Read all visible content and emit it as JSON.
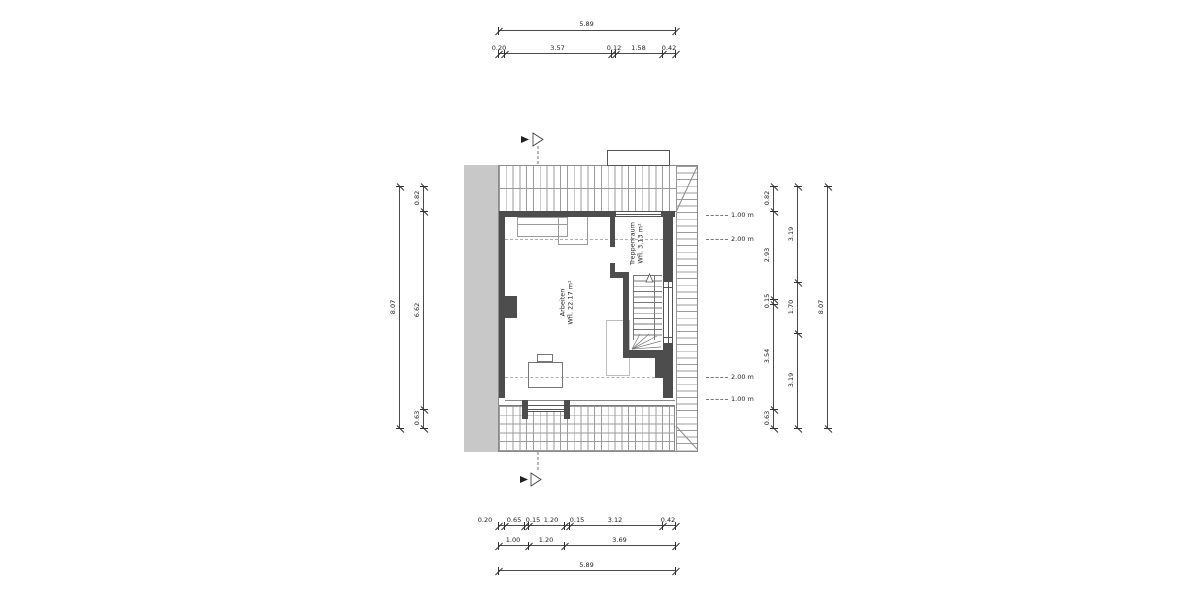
{
  "rooms": {
    "arbeiten": {
      "name": "Arbeiten",
      "area": "Wfl. 22.17 m²"
    },
    "treppenraum": {
      "name": "Treppenraum",
      "area": "Wfl. 3.13 m²"
    }
  },
  "dims": {
    "top_overall": "5.89",
    "top_segments": [
      "0.20",
      "3.57",
      "0.12",
      "1.58",
      "0.42"
    ],
    "bottom_segments": [
      "0.20",
      "0.65",
      "0.15",
      "1.20",
      "0.15",
      "3.12",
      "0.42"
    ],
    "bottom_mid": [
      "1.00",
      "1.20",
      "3.69"
    ],
    "bottom_overall": "5.89",
    "left_segments": [
      "0.82",
      "6.62",
      "0.63"
    ],
    "left_overall": "8.07",
    "right_inner": [
      "0.82",
      "2.93",
      "0.15",
      "3.54",
      "0.63"
    ],
    "right_mid": [
      "3.19",
      "1.70",
      "3.19"
    ],
    "right_overall": "8.07"
  },
  "height_markers": [
    {
      "label": "1.00 m"
    },
    {
      "label": "2.00 m"
    },
    {
      "label": "2.00 m"
    },
    {
      "label": "1.00 m"
    }
  ],
  "colors": {
    "wall": "#4d4d4d",
    "party_wall": "#c8c8c8",
    "dimension_line": "#4a4a4a",
    "hatch": "#9b9b9b"
  }
}
